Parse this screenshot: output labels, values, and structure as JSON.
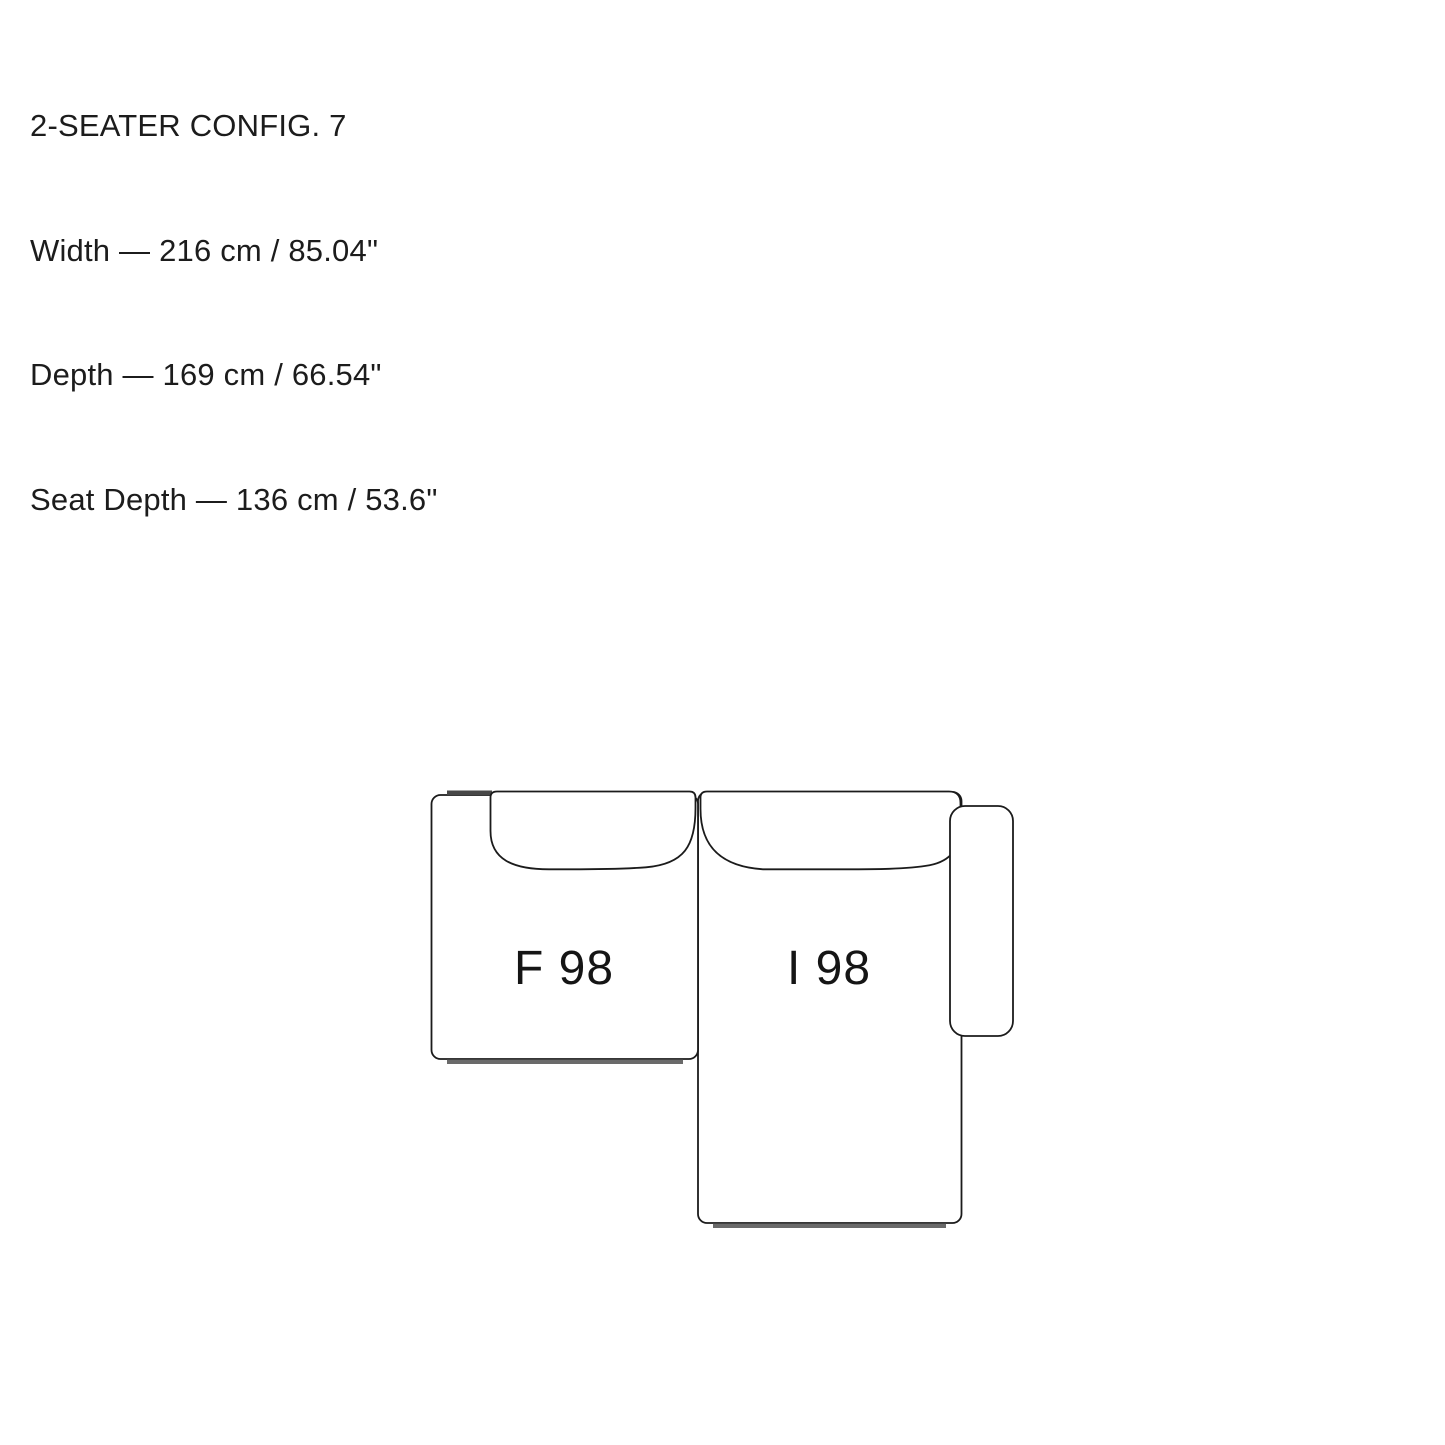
{
  "header": {
    "title": "2-SEATER CONFIG. 7",
    "dimensions": {
      "width": "Width — 216 cm / 85.04\"",
      "depth": "Depth — 169 cm / 66.54\"",
      "seat_depth": "Seat Depth — 136 cm / 53.6\""
    }
  },
  "diagram": {
    "modules": [
      {
        "label": "F 98",
        "position": "left"
      },
      {
        "label": "I 98",
        "position": "right"
      }
    ],
    "colors": {
      "background": "#ffffff",
      "outline": "#1b1b1b",
      "module_fill": "#ffffff",
      "connector_strip": "#474747",
      "plinth_strip": "#6a6a6a",
      "label_text": "#151515"
    }
  }
}
